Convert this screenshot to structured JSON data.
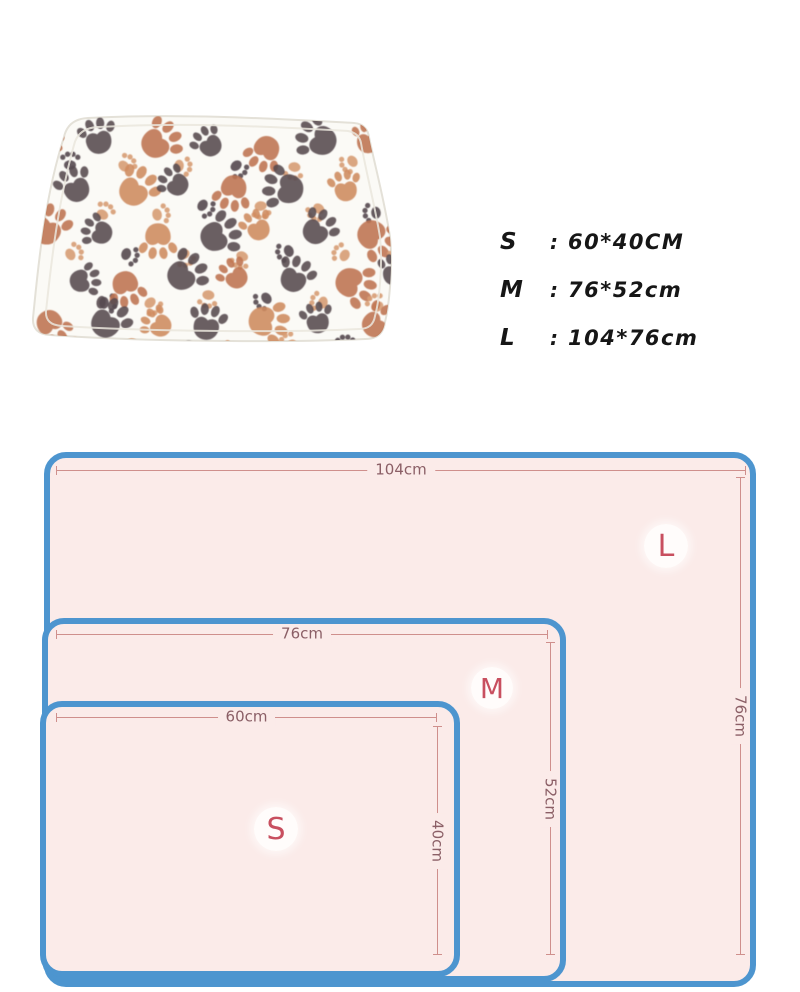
{
  "photo": {
    "name": "paw print pet blanket photo",
    "blanket_color": "#fbfaf6",
    "edge_color": "#e4e1d8",
    "paw_colors": {
      "dark": "#564a4f",
      "terracotta": "#bf7350",
      "terracotta_light": "#cf8a5e",
      "peach": "#d89d74"
    }
  },
  "size_list": {
    "items": [
      {
        "label": "S",
        "separator": ":",
        "value": "60*40CM"
      },
      {
        "label": "M",
        "separator": ":",
        "value": "76*52cm"
      },
      {
        "label": "L",
        "separator": ":",
        "value": "104*76cm"
      }
    ]
  },
  "diagram": {
    "border_color": "#4d95cf",
    "fill_color": "#fbebe9",
    "dim_line_color": "#cf8f8c",
    "dim_label_color": "#8b5f66",
    "badge_color": "#c84f5f",
    "sizes": [
      {
        "id": "L",
        "width_label": "104cm",
        "height_label": "76cm"
      },
      {
        "id": "M",
        "width_label": "76cm",
        "height_label": "52cm"
      },
      {
        "id": "S",
        "width_label": "60cm",
        "height_label": "40cm"
      }
    ]
  }
}
